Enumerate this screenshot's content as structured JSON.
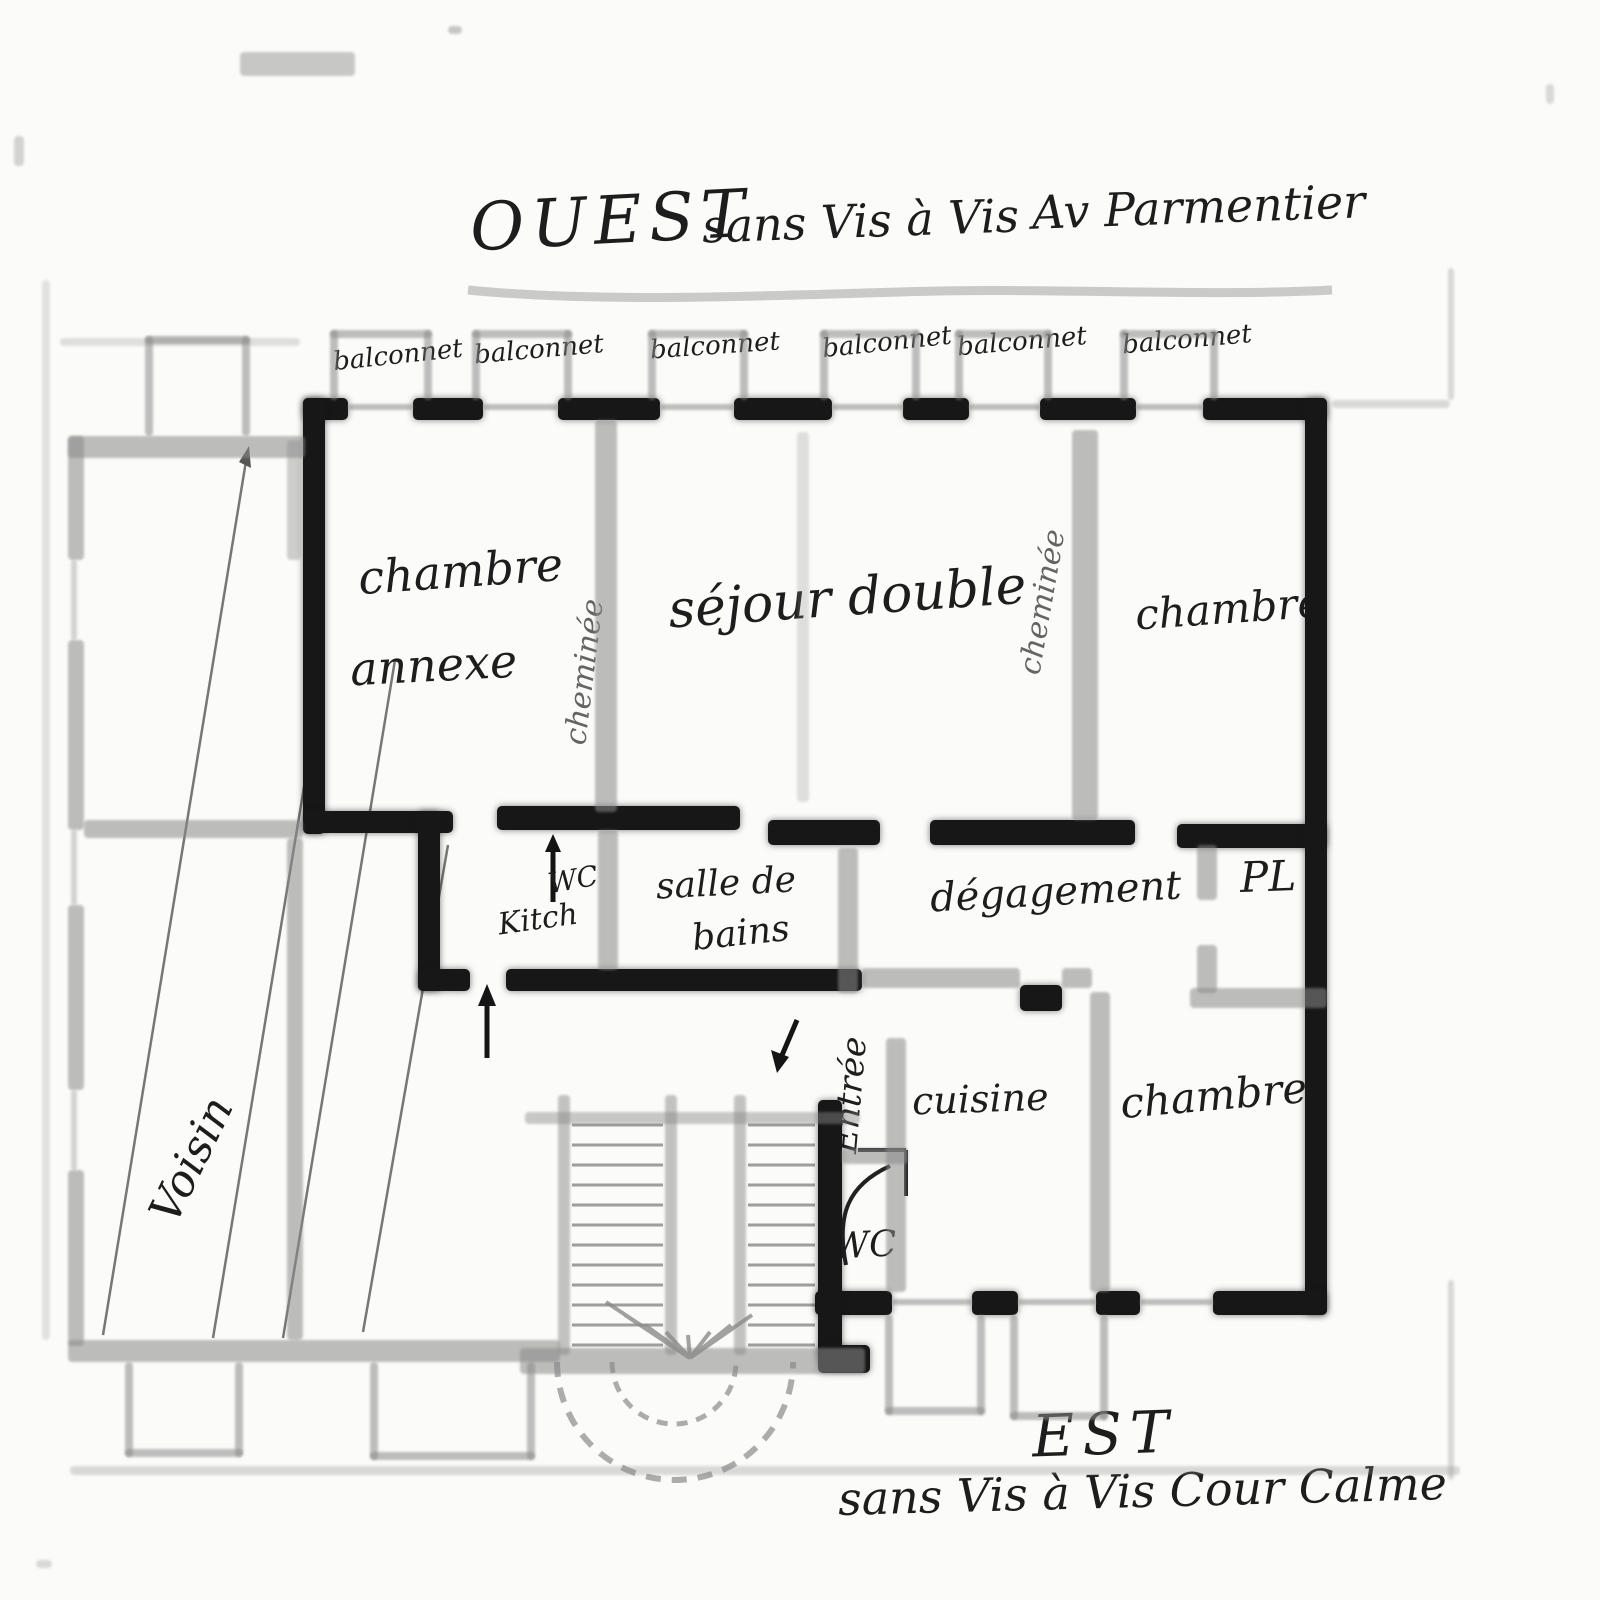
{
  "titles": {
    "west": {
      "direction": "OUEST",
      "note": "sans Vis à Vis",
      "street": "Av Parmentier"
    },
    "east": {
      "direction": "EST",
      "note": "sans Vis à Vis Cour Calme"
    }
  },
  "balconies": {
    "items": [
      "balconnet",
      "balconnet",
      "balconnet",
      "balconnet",
      "balconnet",
      "balconnet"
    ]
  },
  "rooms": {
    "chambre_annexe_line1": "chambre",
    "chambre_annexe_line2": "annexe",
    "cheminee_left": "cheminée",
    "sejour": "séjour double",
    "cheminee_right": "cheminée",
    "chambre_right": "chambre",
    "salle_de_bains_line1": "salle de",
    "salle_de_bains_line2": "bains",
    "scribble_wc": "WC",
    "scribble_kitch": "Kitch",
    "degagement": "dégagement",
    "placard": "PL",
    "cuisine": "cuisine",
    "chambre_bottom": "chambre",
    "entree": "Entrée",
    "wc": "WC",
    "voisin": "Voisin"
  }
}
